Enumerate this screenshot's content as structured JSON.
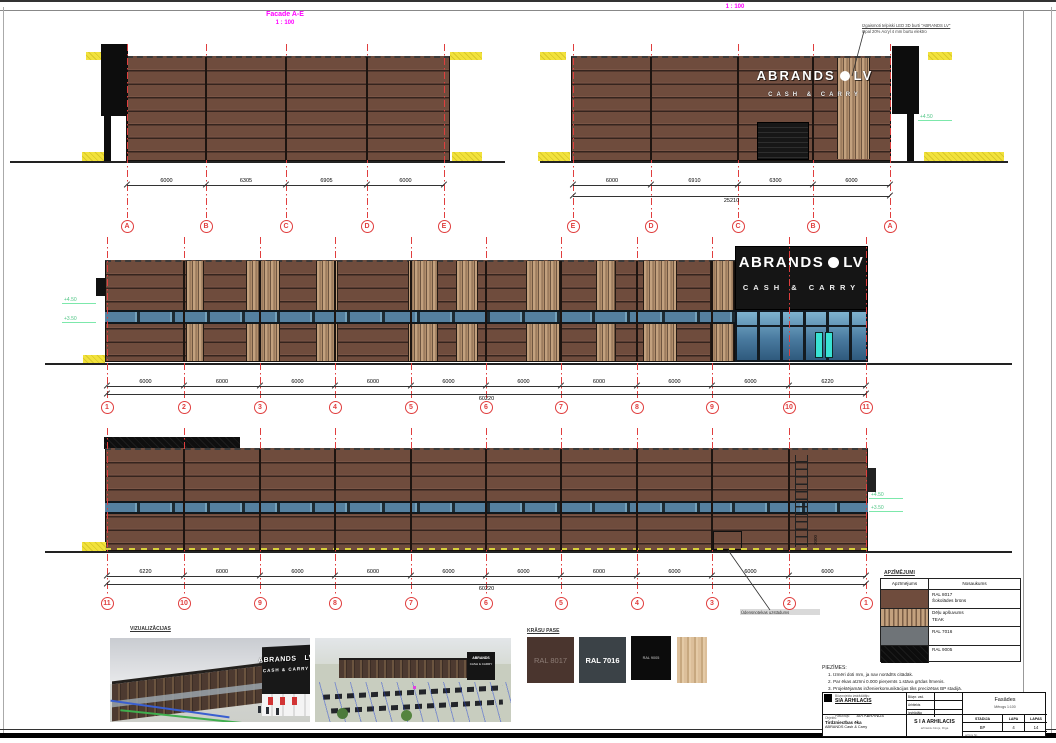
{
  "titles": {
    "facade_ae": "Facade A-E",
    "facade_ae_scale": "1 : 100",
    "facade_ea_scale": "1 : 100"
  },
  "sign": {
    "brand": "ABRANDS",
    "suffix": "LV",
    "tagline": "CASH & CARRY"
  },
  "annotation": {
    "line1": "Izgaismoti telpiski LED 3D burti \"ABRANDS LV\"",
    "line2": "Opal 20% Acryl 4 mm burtu elektro"
  },
  "facades": {
    "ae": {
      "grids": [
        "A",
        "B",
        "C",
        "D",
        "E"
      ],
      "dims": [
        "6000",
        "6305",
        "6905",
        "6000"
      ]
    },
    "ea": {
      "grids": [
        "E",
        "D",
        "C",
        "B",
        "A"
      ],
      "dims": [
        "6000",
        "6910",
        "6300",
        "6000"
      ],
      "total": "25210",
      "level": "+4.50"
    },
    "f1": {
      "grids": [
        "1",
        "2",
        "3",
        "4",
        "5",
        "6",
        "7",
        "8",
        "9",
        "10",
        "11"
      ],
      "dims": [
        "6000",
        "6000",
        "6000",
        "6000",
        "6000",
        "6000",
        "6000",
        "6000",
        "6000",
        "6220"
      ],
      "total": "60220",
      "levels": [
        "+4.50",
        "+3.50"
      ]
    },
    "f2": {
      "grids": [
        "11",
        "10",
        "9",
        "8",
        "7",
        "6",
        "5",
        "4",
        "3",
        "2",
        "1"
      ],
      "dims": [
        "6220",
        "6000",
        "6000",
        "6000",
        "6000",
        "6000",
        "6000",
        "6000",
        "6000",
        "6000"
      ],
      "total": "60220",
      "levels": [
        "+4.50",
        "+3.50"
      ],
      "ladder_dim": "3000",
      "door_note": "Ūdensnotekas uzstādums"
    }
  },
  "visuals": {
    "label": "VIZUALIZĀCIJAS"
  },
  "krasu_pase": {
    "label": "KRĀSU PASE",
    "swatches": [
      {
        "name": "RAL 8017"
      },
      {
        "name": "RAL 7016"
      },
      {
        "name": "RAL 9005"
      },
      {
        "name": "TEAK"
      }
    ]
  },
  "legend": {
    "label": "APZĪMĒJUMI",
    "columns": [
      "Apzīmējums",
      "Nosaukums"
    ],
    "rows": [
      {
        "name": "RAL 8017",
        "desc": "Šokolādes brūns",
        "type": "lg-brown"
      },
      {
        "name": "Dēļu apšuvums",
        "desc": "TEAK",
        "type": "lg-teak"
      },
      {
        "name": "RAL 7016",
        "desc": "",
        "type": "lg-grey"
      },
      {
        "name": "RAL 9005",
        "desc": "",
        "type": "lg-black"
      }
    ]
  },
  "notes": {
    "label": "PIEZĪMES:",
    "items": [
      "Izmēri doti mm, ja nav norādīts citādāk.",
      "Par ēkas atzīmi 0.000 pieņemts 1.stāva grīdas līmenis.",
      "Projektējamās inženierkomunikācijas tiks precizētas BP stadijā.",
      "Rasējumus nemērīt."
    ]
  },
  "titleblock": {
    "company_label": "Būvprojekta izstrādātājs:",
    "company": "SIA ARHILACIS",
    "client_label": "Pasūtītājs:",
    "client": "SIA ABRANDS",
    "object_label": "Objekts:",
    "object": "Tirdzniecības ēka",
    "object_sub": "ABRANDS Cash & Carry",
    "roles": [
      [
        "Būvpr. vad.",
        ""
      ],
      [
        "Arhitekts",
        ""
      ],
      [
        "Izstrādāja",
        ""
      ]
    ],
    "firm": "S I A  ARHILACIS",
    "firm_sub": "arhitektu birojs, Rīga",
    "sheet_title": "Fasādes",
    "scale": "Mērogs 1:100",
    "stage_label": "STADIJA",
    "sheet_label": "LAPA",
    "sheets_label": "LAPAS",
    "stage": "BP",
    "sheet": "4",
    "sheets": "14",
    "archive": "arhīvs Nr."
  },
  "colors": {
    "brown": "#6f4c3d",
    "teak": "#c3a17e",
    "window": "#55809f",
    "sign": "#151515",
    "grid_red": "#e03e3e",
    "level_green": "#7ce8ab",
    "magenta": "#ff00ff"
  }
}
